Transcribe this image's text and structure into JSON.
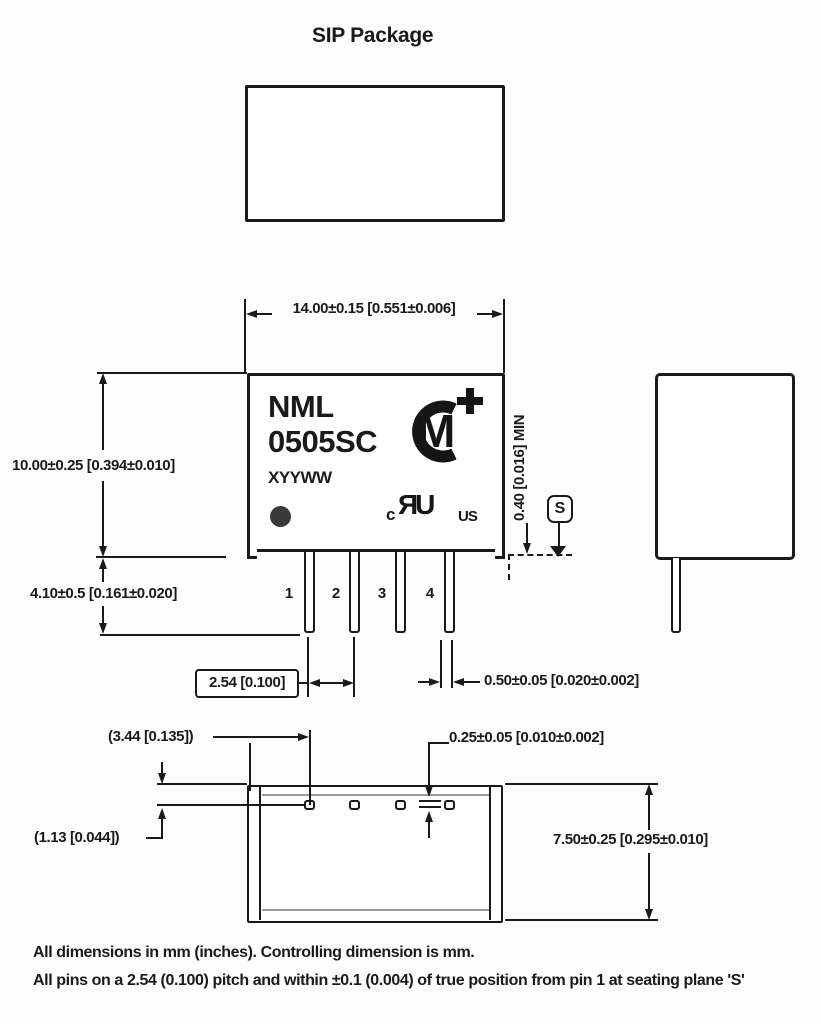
{
  "title": "SIP Package",
  "module": {
    "model_line1": "NML",
    "model_line2": "0505SC",
    "date_code": "XYYWW",
    "pin_numbers": [
      "1",
      "2",
      "3",
      "4"
    ],
    "logos": {
      "murata_m": "M",
      "ul_c": "c",
      "ul_mark": "ЯU",
      "ul_us": "US"
    }
  },
  "dimensions": {
    "body_width": "14.00±0.15 [0.551±0.006]",
    "body_height": "10.00±0.25 [0.394±0.010]",
    "pin_length": "4.10±0.5 [0.161±0.020]",
    "pin_pitch": "2.54 [0.100]",
    "pin_width": "0.50±0.05 [0.020±0.002]",
    "standoff_min": "0.40 [0.016] MIN",
    "seating_plane_datum": "S",
    "pin1_inset": "(3.44 [0.135])",
    "pad_inset": "(1.13 [0.044])",
    "pad_thickness": "0.25±0.05 [0.010±0.002]",
    "body_depth": "7.50±0.25 [0.295±0.010]"
  },
  "notes": [
    "All dimensions in mm (inches). Controlling dimension is mm.",
    "All pins on a 2.54 (0.100) pitch and within ±0.1 (0.004) of true position from pin 1 at seating plane 'S'"
  ],
  "colors": {
    "ink": "#1a1a1a",
    "secondary_line": "#9a9a9a",
    "background": "#fdfdfd"
  }
}
